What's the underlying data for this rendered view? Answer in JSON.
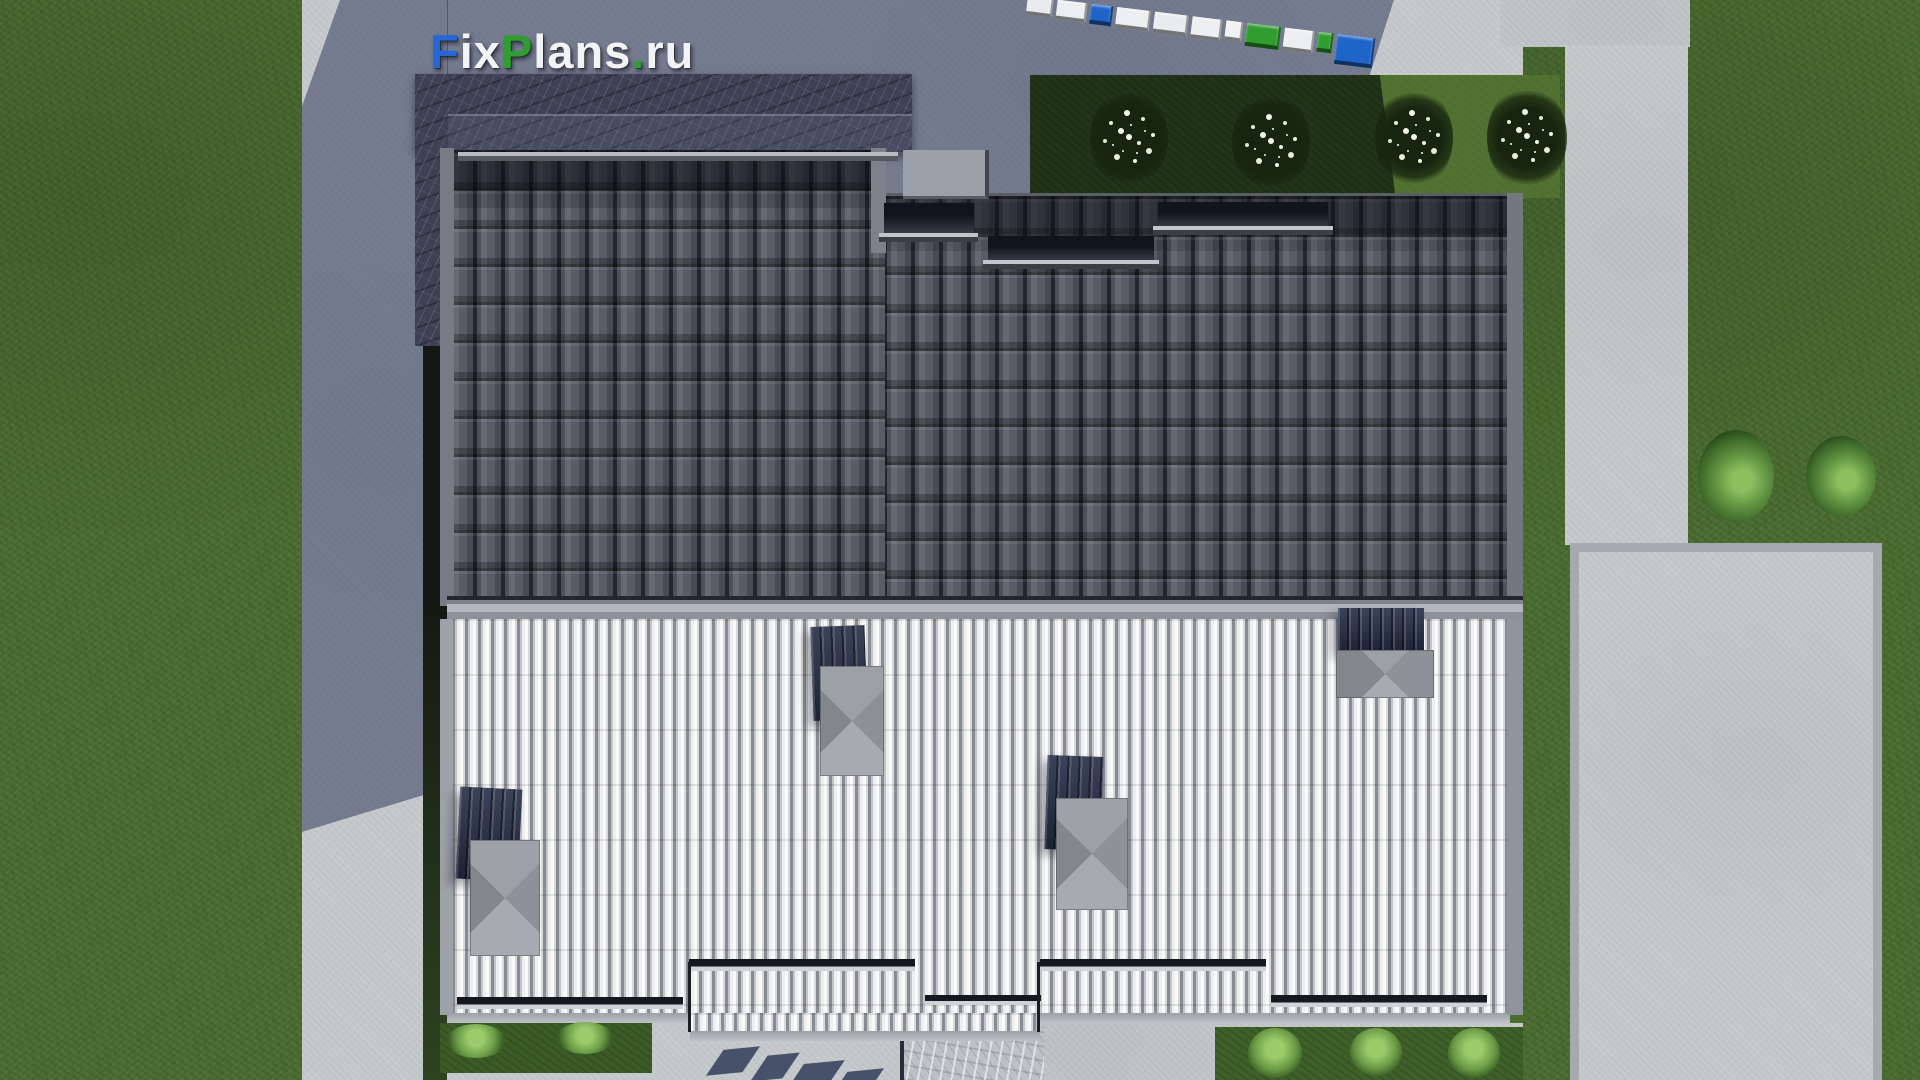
{
  "watermark": {
    "text": "FixPlans.ru",
    "parts": [
      {
        "text": "F",
        "color": "#2667d6"
      },
      {
        "text": "ix",
        "color": "#f2f3f5"
      },
      {
        "text": "P",
        "color": "#2f9e2f"
      },
      {
        "text": "lans",
        "color": "#f2f3f5"
      },
      {
        "text": ".",
        "color": "#2f9e2f"
      },
      {
        "text": "ru",
        "color": "#f2f3f5"
      }
    ]
  },
  "logo_blocks": {
    "items": [
      {
        "bg": "#e9ebee",
        "w": 24,
        "h": 15
      },
      {
        "bg": "#eceef0",
        "w": 28,
        "h": 16
      },
      {
        "bg": "#1f64c8",
        "w": 20,
        "h": 16
      },
      {
        "bg": "#eceef0",
        "w": 32,
        "h": 17
      },
      {
        "bg": "#e9ebee",
        "w": 32,
        "h": 17
      },
      {
        "bg": "#eceef0",
        "w": 28,
        "h": 18
      },
      {
        "bg": "#f0f2f4",
        "w": 15,
        "h": 16
      },
      {
        "bg": "#2f9e2f",
        "w": 32,
        "h": 19
      },
      {
        "bg": "#eceef0",
        "w": 28,
        "h": 19
      },
      {
        "bg": "#2f9e2f",
        "w": 13,
        "h": 16
      },
      {
        "bg": "#1f64c8",
        "w": 36,
        "h": 26
      }
    ]
  },
  "palette": {
    "grass": "#4b6d31",
    "grassDark": "#22351a",
    "concrete": "#c6c9cc",
    "tile": "#4a4e58",
    "rib": "#e9eaec",
    "navy": "#262e47",
    "marble": "#3c4154",
    "brandBlue": "#2667d6",
    "brandGreen": "#2f9e2f"
  },
  "scene": {
    "description_labels": {
      "building": "house roof top view",
      "dark_slope": "dark tiled roof slope",
      "light_slope": "light metal seam roof slope",
      "skylights": "roof windows with chimney panels",
      "lawn": "lawn",
      "walkways": "concrete walkways"
    }
  }
}
